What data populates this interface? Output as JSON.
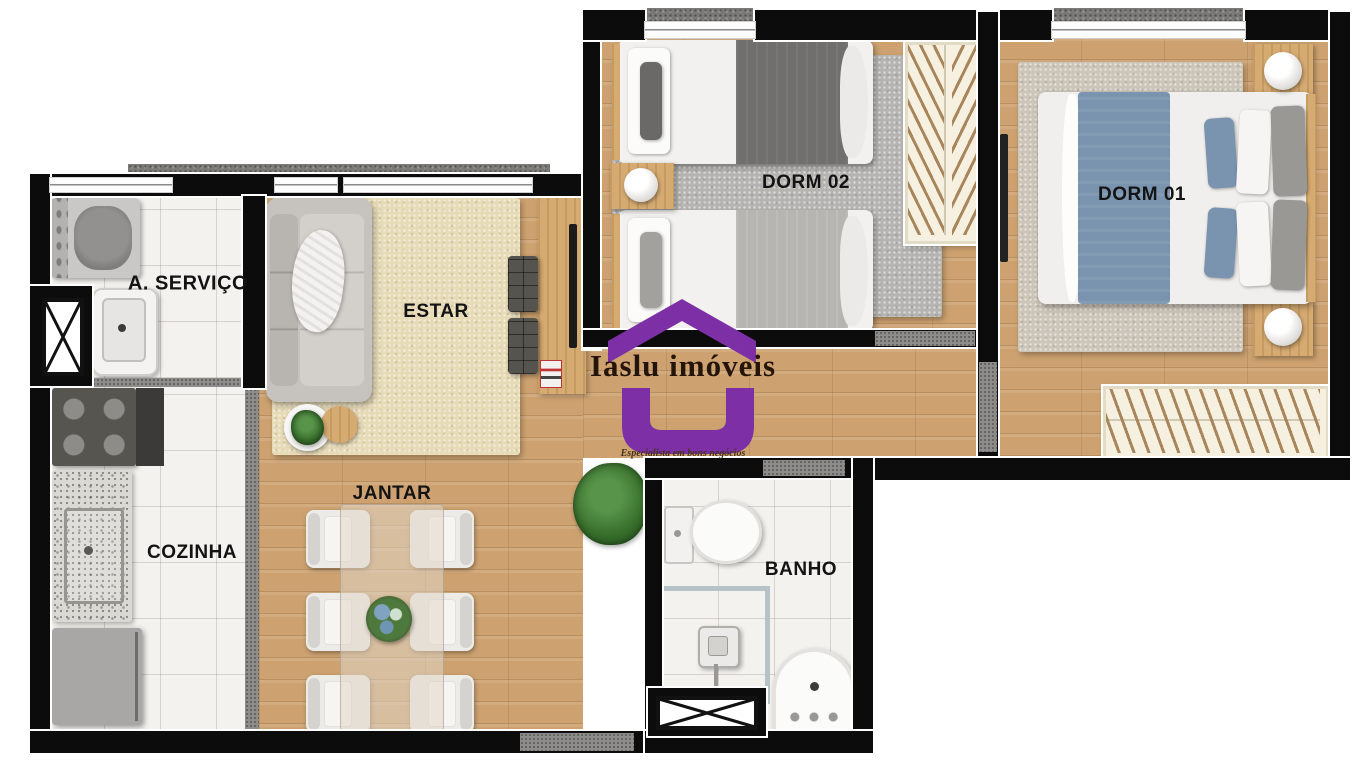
{
  "brand": {
    "name": "Iaslu imóveis",
    "tagline": "Especialista em bons negócios",
    "accent_color": "#7d30a6",
    "text_color": "#251408"
  },
  "rooms": {
    "servico": {
      "label": "A. SERVIÇO"
    },
    "estar": {
      "label": "ESTAR"
    },
    "dorm02": {
      "label": "DORM 02"
    },
    "dorm01": {
      "label": "DORM 01"
    },
    "cozinha": {
      "label": "COZINHA"
    },
    "jantar": {
      "label": "JANTAR"
    },
    "banho": {
      "label": "BANHO"
    }
  },
  "colors": {
    "wall": "#0c0c0c",
    "wood_floor": "#cda270",
    "tile_floor": "#f4f2ee",
    "exterior_band": "#7b7a78",
    "estar_rug": "#e7dab6",
    "dorm02_rug": "#b6b4b1",
    "dorm01_rug": "#ccc5b9",
    "blanket_dark": "#716f6d",
    "blanket_light": "#b7b5b1",
    "blanket_blue": "#7a93ae",
    "furniture_wood": "#d6ab72"
  }
}
